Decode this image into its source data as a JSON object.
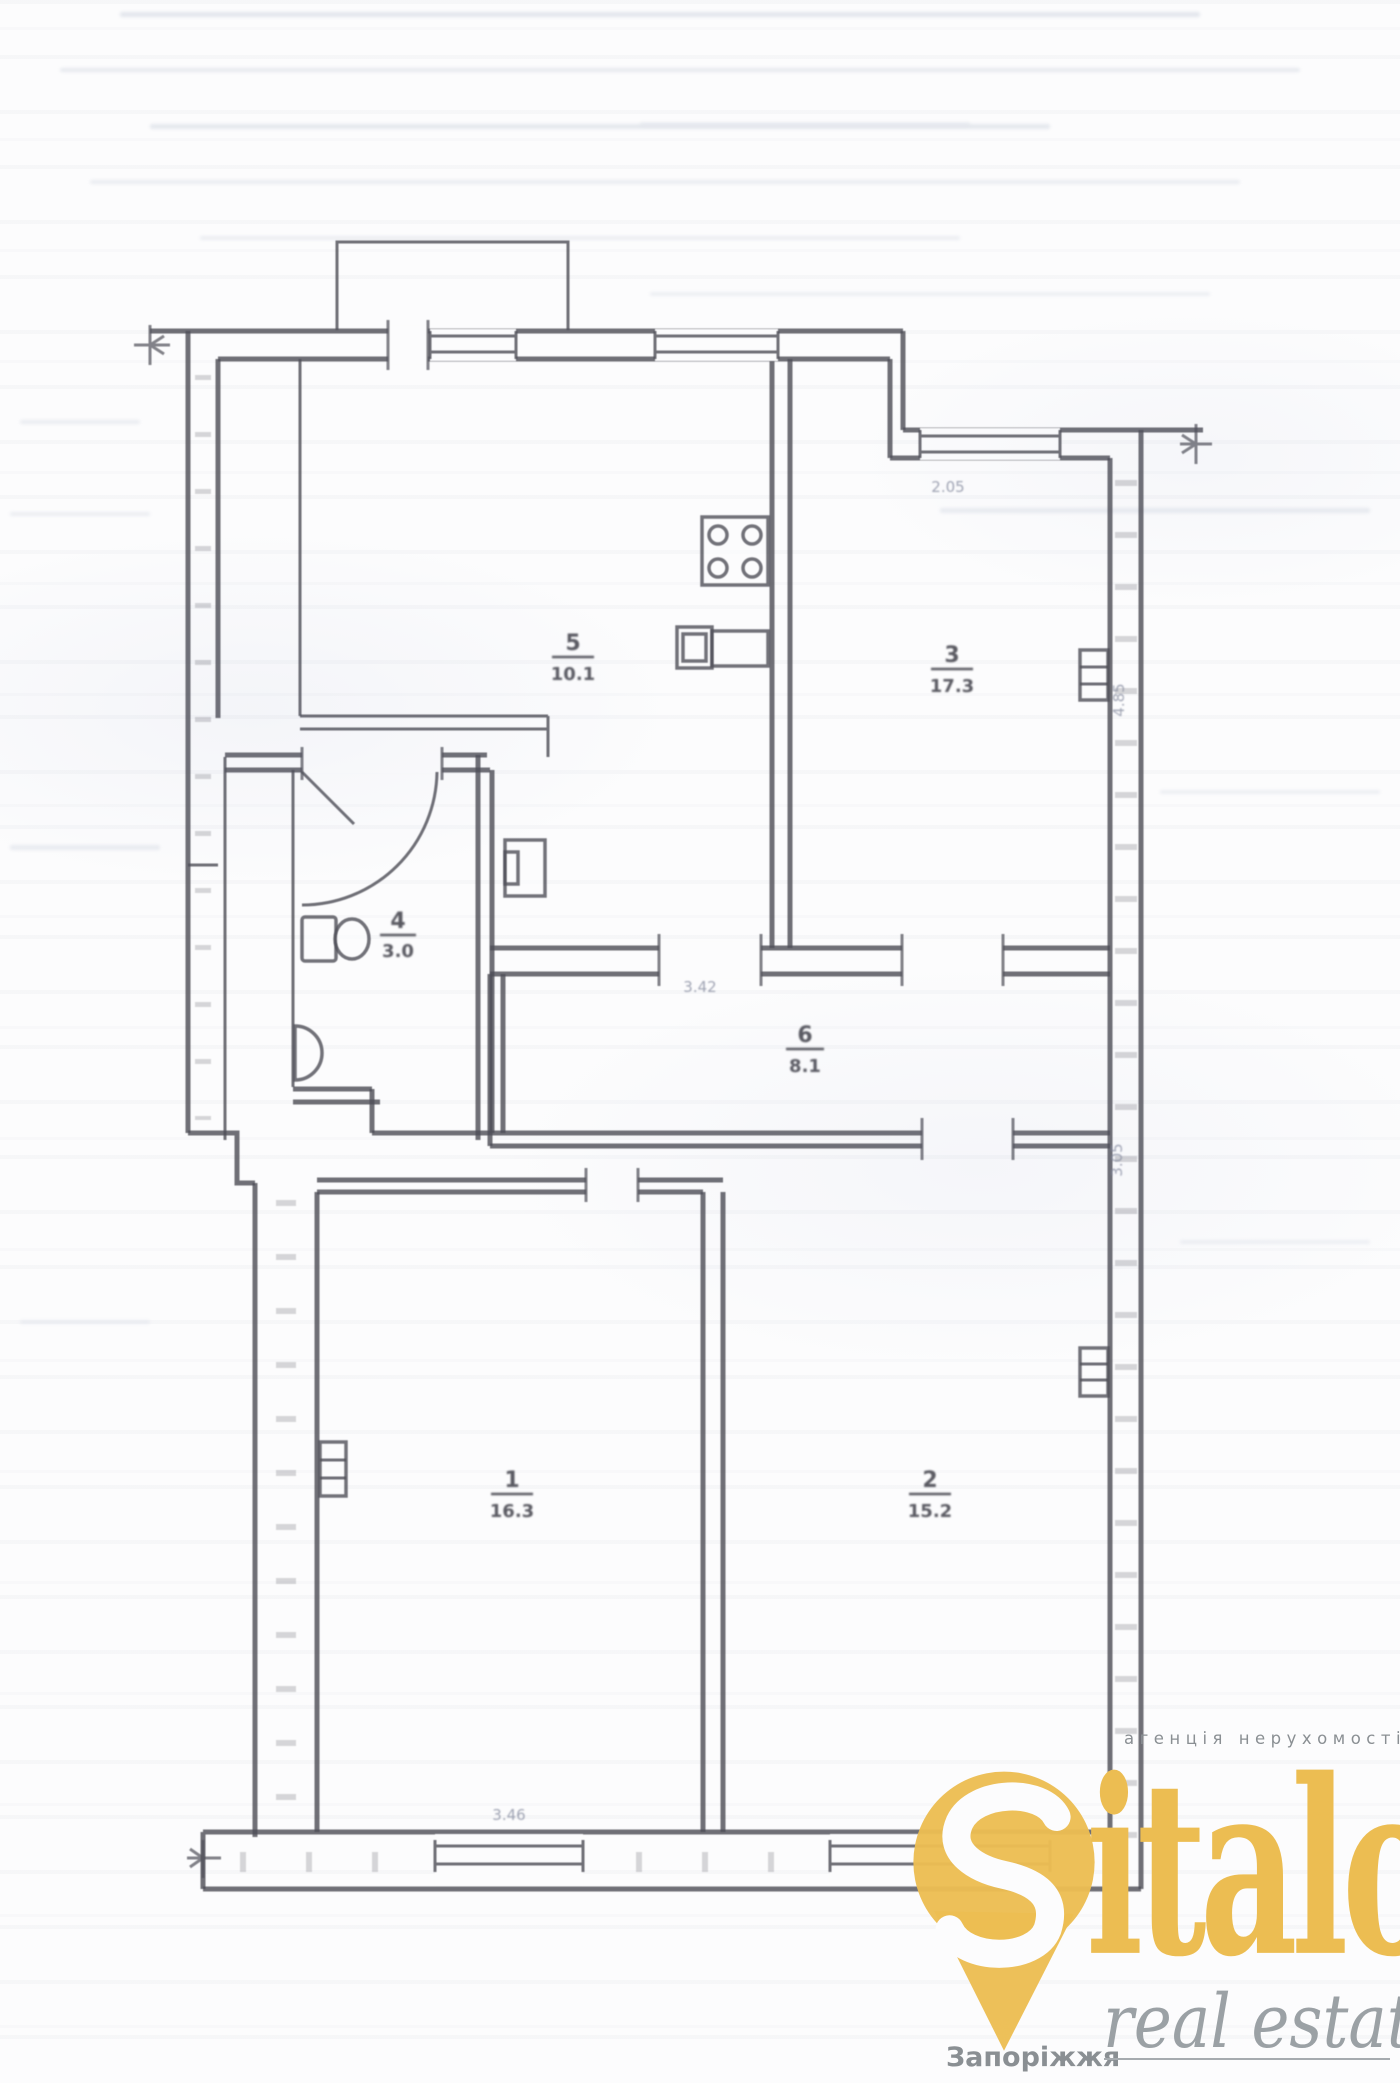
{
  "rooms": [
    {
      "id": "room-1",
      "number": "1",
      "area": "16.3"
    },
    {
      "id": "room-2",
      "number": "2",
      "area": "15.2"
    },
    {
      "id": "room-3",
      "number": "3",
      "area": "17.3"
    },
    {
      "id": "bathroom",
      "number": "4",
      "area": "3.0"
    },
    {
      "id": "kitchen",
      "number": "5",
      "area": "10.1"
    },
    {
      "id": "hallway",
      "number": "6",
      "area": "8.1"
    }
  ],
  "dimensions": [
    "2.05",
    "3.42",
    "4.85",
    "3.05",
    "3.46"
  ],
  "watermark": {
    "agency_line": "агенція нерухомості",
    "brand_rest": "italo",
    "tagline": "real estate",
    "city": "Запоріжжя",
    "brand_color": "#ecbd52",
    "gray_color": "#9ba1a5"
  }
}
